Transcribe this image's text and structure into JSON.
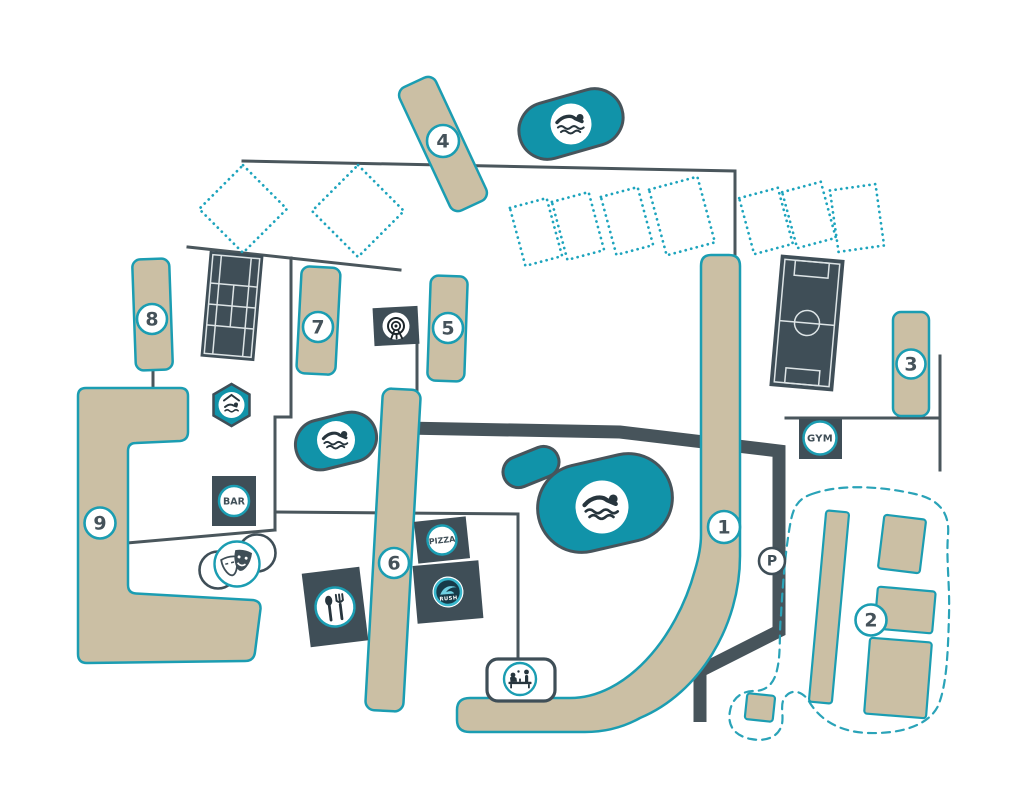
{
  "map": {
    "markers": [
      {
        "label": "1"
      },
      {
        "label": "2"
      },
      {
        "label": "3"
      },
      {
        "label": "4"
      },
      {
        "label": "5"
      },
      {
        "label": "6"
      },
      {
        "label": "7"
      },
      {
        "label": "8"
      },
      {
        "label": "9"
      }
    ],
    "parking": {
      "label": "P"
    },
    "amenities": {
      "gym": {
        "label": "GYM"
      },
      "bar": {
        "label": "BAR"
      },
      "pizza": {
        "label": "PIZZA"
      },
      "waterpark_logo": {
        "label": "RUSH"
      },
      "icons": [
        "swimmer-icon",
        "indoor-pool-icon",
        "theatre-masks-icon",
        "restaurant-cutlery-icon",
        "archery-target-icon",
        "table-tennis-icon",
        "parking-icon",
        "tennis-court",
        "football-pitch"
      ]
    },
    "colors": {
      "teal": "#1b9db2",
      "pool_fill": "#1193a9",
      "building_tan": "#cbbfa4",
      "slate": "#3f4e57",
      "road": "#47545b",
      "background": "#ffffff"
    }
  }
}
